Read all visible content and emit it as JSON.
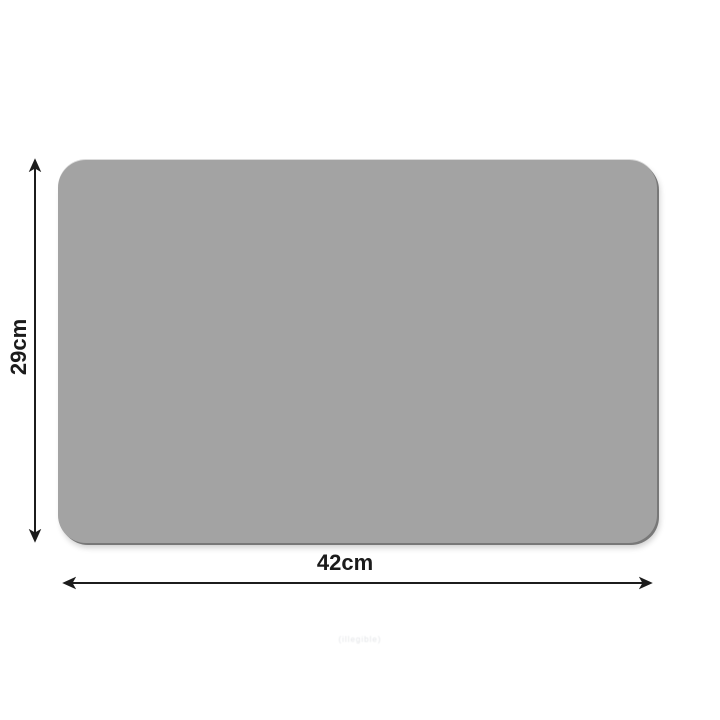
{
  "diagram": {
    "title": "placemat-dimension-diagram",
    "mat": {
      "fill_color": "#a3a3a3"
    },
    "dimensions": {
      "width": {
        "label": "42cm"
      },
      "height": {
        "label": "29cm"
      }
    },
    "arrow_color": "#1c1c1c",
    "label_color": "#1b1b1b",
    "background_color": "#ffffff",
    "watermark": {
      "text": "(illegible)"
    }
  }
}
